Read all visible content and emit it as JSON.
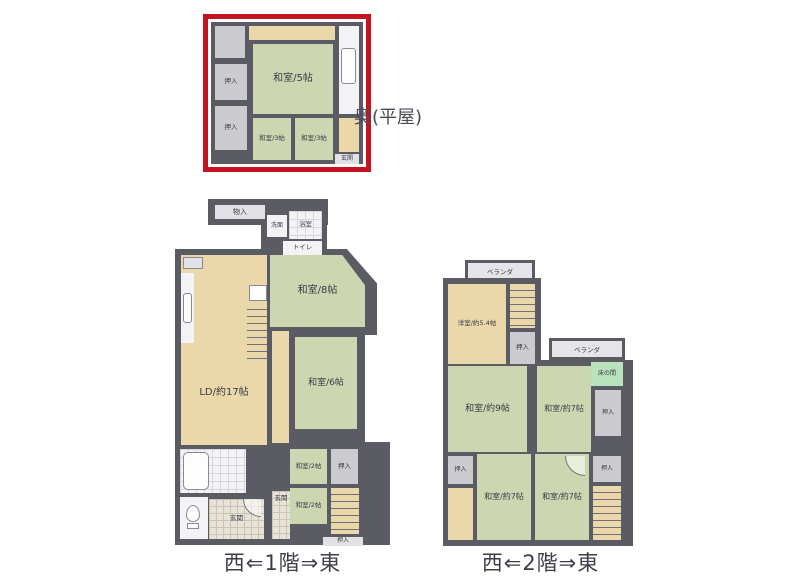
{
  "colors": {
    "wall": "#5b5b63",
    "tatami_green": "#ccd7b2",
    "wood_tan": "#ead7aa",
    "closet_gray": "#cbcbd0",
    "white_room": "#f3f3f6",
    "tokonoma_mint": "#b9e3bd",
    "highlight_red": "#c41420",
    "text": "#3b3b45"
  },
  "annex": {
    "title": "奥(平屋)",
    "rooms": {
      "washitsu5": "和室/5帖",
      "washitsu3a": "和室/3帖",
      "washitsu3b": "和室/3帖",
      "oshiire1": "押入",
      "oshiire2": "押入",
      "genkan": "玄関"
    }
  },
  "floor1": {
    "caption": "西⇐1階⇒東",
    "rooms": {
      "monoire": "物入",
      "senmen": "洗面",
      "yokushitsu": "浴室",
      "toire": "トイレ",
      "washitsu8": "和室/8帖",
      "ld": "LD/約17帖",
      "washitsu6": "和室/6帖",
      "washitsu2a": "和室/2帖",
      "washitsu2b": "和室/2帖",
      "oshiireA": "押入",
      "oshiireB": "押入",
      "genkan1": "玄関",
      "genkan2": "玄関"
    }
  },
  "floor2": {
    "caption": "西⇐2階⇒東",
    "rooms": {
      "verandaTop": "ベランダ",
      "verandaRight": "ベランダ",
      "youshitsu": "洋室/約5.4帖",
      "washitsu9": "和室/約9帖",
      "washitsu7a": "和室/約7帖",
      "washitsu7b": "和室/約7帖",
      "washitsu7c": "和室/約7帖",
      "tokonoma": "床の間",
      "oshiireA": "押入",
      "oshiireB": "押入",
      "oshiireC": "押入",
      "oshiireD": "押入"
    }
  }
}
